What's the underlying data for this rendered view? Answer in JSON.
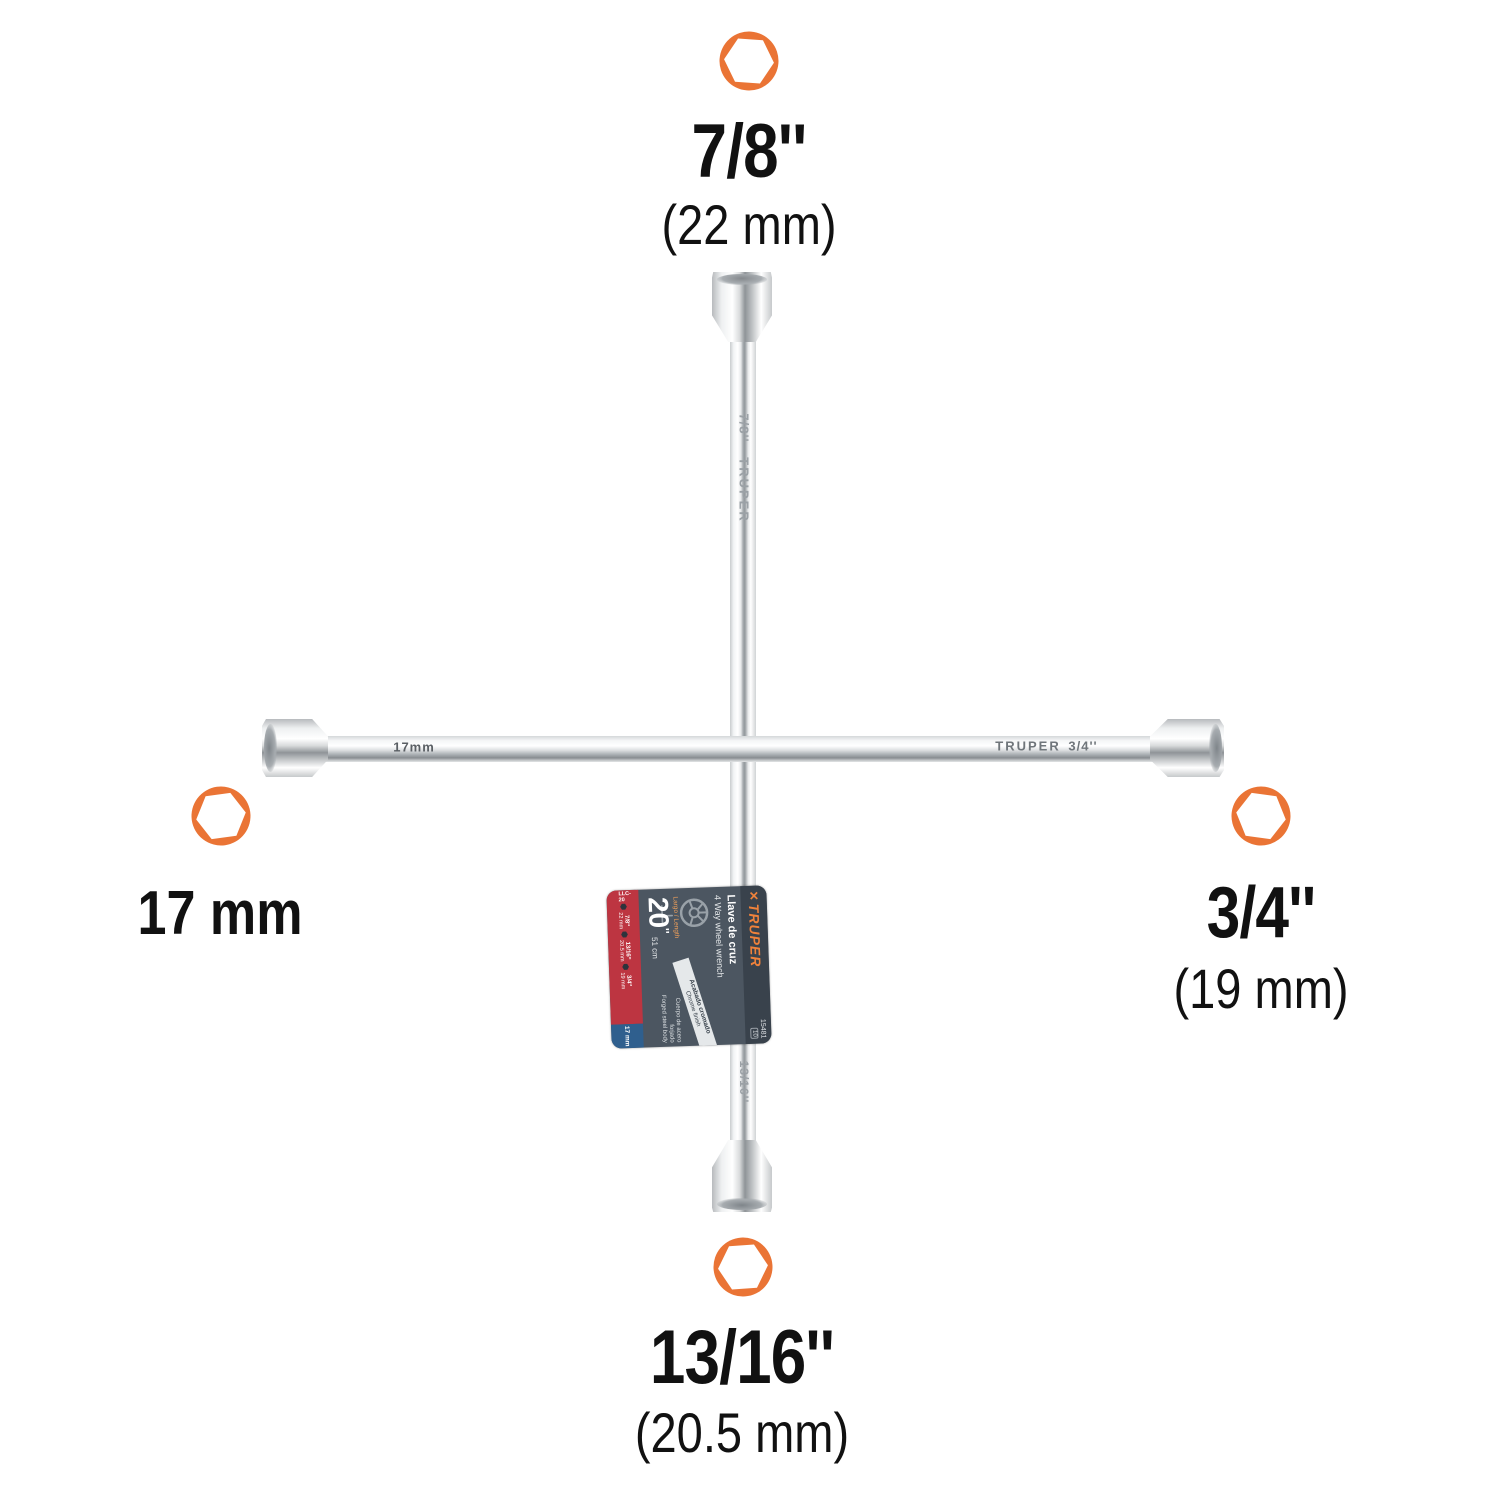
{
  "scene": {
    "type": "product-infographic",
    "product": "4-way lug wrench (cross wheel wrench)",
    "background_color": "#ffffff"
  },
  "colors": {
    "hex_icon_orange": "#EA7435",
    "tag_red": "#BD3541",
    "tag_blue": "#2F5F8E",
    "tag_slate": "#4C5661",
    "tag_header_dark": "#39424C",
    "brand_orange": "#F0823B",
    "metal_light": "#F5F6F7",
    "metal_dark": "#888D91"
  },
  "callouts": {
    "top": {
      "size": "7/8''",
      "mm": "(22 mm)"
    },
    "left": {
      "size": "17 mm",
      "mm": ""
    },
    "right": {
      "size": "3/4''",
      "mm": "(19 mm)"
    },
    "bottom": {
      "size": "13/16''",
      "mm": "(20.5 mm)"
    }
  },
  "engravings": {
    "vertical_top_size": "7/8''",
    "vertical_brand": "TRUPER",
    "left_arm_size": "17mm",
    "right_arm_brand": "TRUPER",
    "right_arm_size": "3/4''",
    "bottom_size": "13/16''"
  },
  "tag": {
    "logo_mark": "✕",
    "brand": "TRUPER",
    "sku": "15481",
    "warranty_badge": "10",
    "title_es": "Llave de cruz",
    "title_en": "4 Way wheel wrench",
    "length_label": "Largo / Length",
    "length_value": "20",
    "length_unit": "''",
    "length_cm": "51 cm",
    "finish_es": "Acabado cromado",
    "finish_en": "Chrome finish",
    "body_es": "Cuerpo de acero forjado",
    "body_en": "Forged steel body",
    "model": "LLC-20",
    "hex_bullet": "⬢",
    "sizes": [
      {
        "size": "7/8''",
        "mm": "22 mm"
      },
      {
        "size": "13/16''",
        "mm": "20.5 mm"
      },
      {
        "size": "3/4''",
        "mm": "19 mm"
      }
    ],
    "metric_size": "17 mm"
  }
}
